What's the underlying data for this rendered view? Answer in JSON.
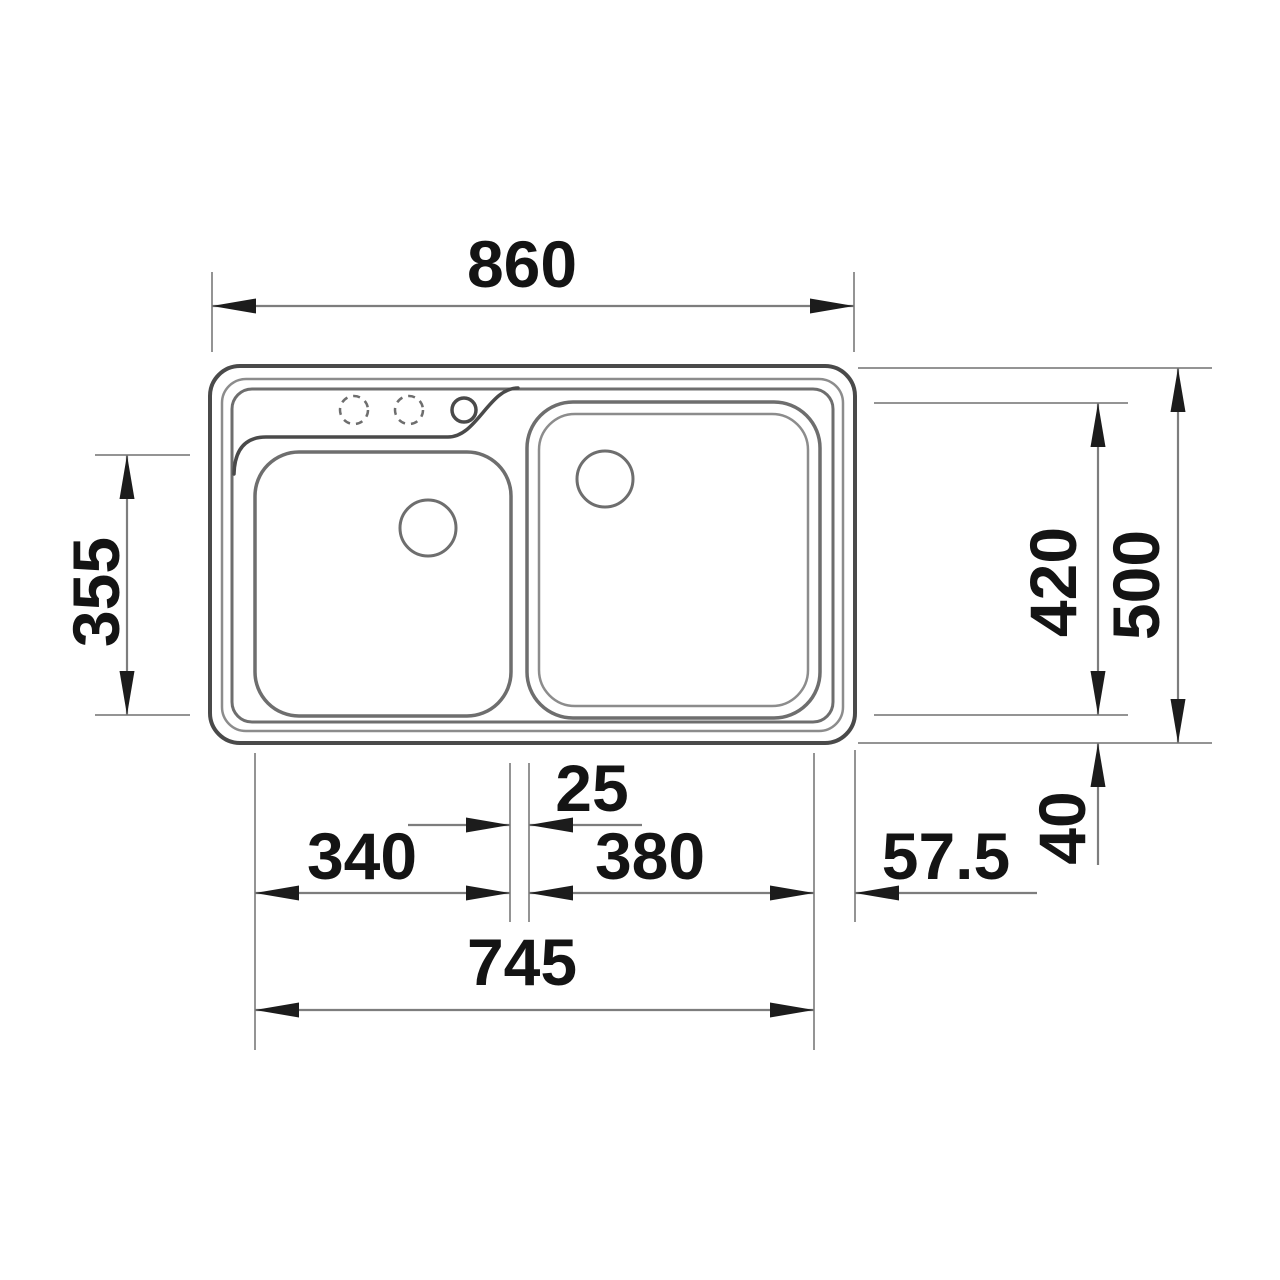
{
  "page": {
    "description": "Technical top-view dimension drawing of a double-bowl inset kitchen sink"
  },
  "dimensions": {
    "overall_width": "860",
    "left_bowl_depth": "355",
    "right_bowl_depth": "420",
    "overall_depth": "500",
    "bottom_edge_offset": "40",
    "bowl_gap": "25",
    "left_bowl_width": "340",
    "right_bowl_width": "380",
    "right_edge_offset": "57.5",
    "bowls_overall_width": "745"
  },
  "colors": {
    "outline-dark": "#4a4a4a",
    "outline-mid": "#6e6e6e",
    "outline-light": "#8c8c8c",
    "dim-line": "#7d7d7d",
    "ext-line": "#949494",
    "arrow": "#1c1c1c",
    "text": "#141414",
    "background": "#ffffff"
  }
}
